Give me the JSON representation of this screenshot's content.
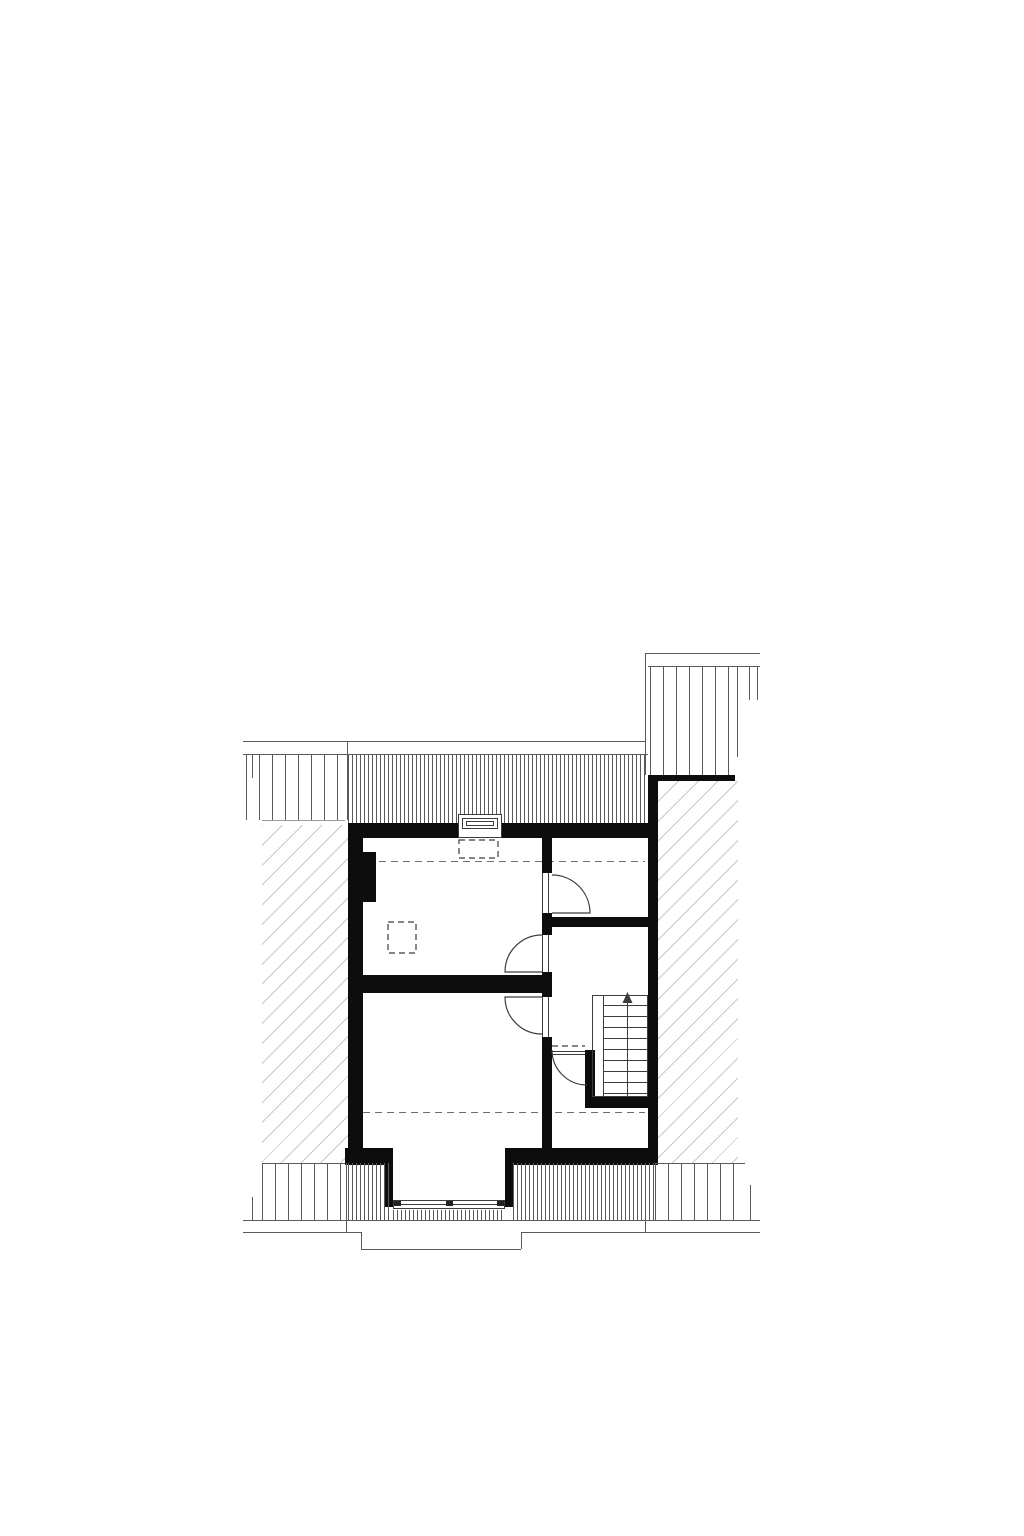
{
  "drawing": {
    "kind": "architectural-floor-plan",
    "room_count": 4,
    "door_swing_count": 4,
    "stair": {
      "direction": "up",
      "tread_count": 9,
      "arrow_glyph": "↑"
    },
    "roof_window_count": 1,
    "dormer_window_count": 1,
    "dashed_guide_line_count": 2,
    "chimney_count": 1
  },
  "colors": {
    "background": "#ffffff",
    "wall": "#0d0d0d",
    "line_strong": "#3c3c3c",
    "line": "#5a5a5a",
    "line_light": "#9a9a9a",
    "dash": "#6f6f6f",
    "hatch": "#c8c8c8",
    "frame_mark": "#222222"
  }
}
